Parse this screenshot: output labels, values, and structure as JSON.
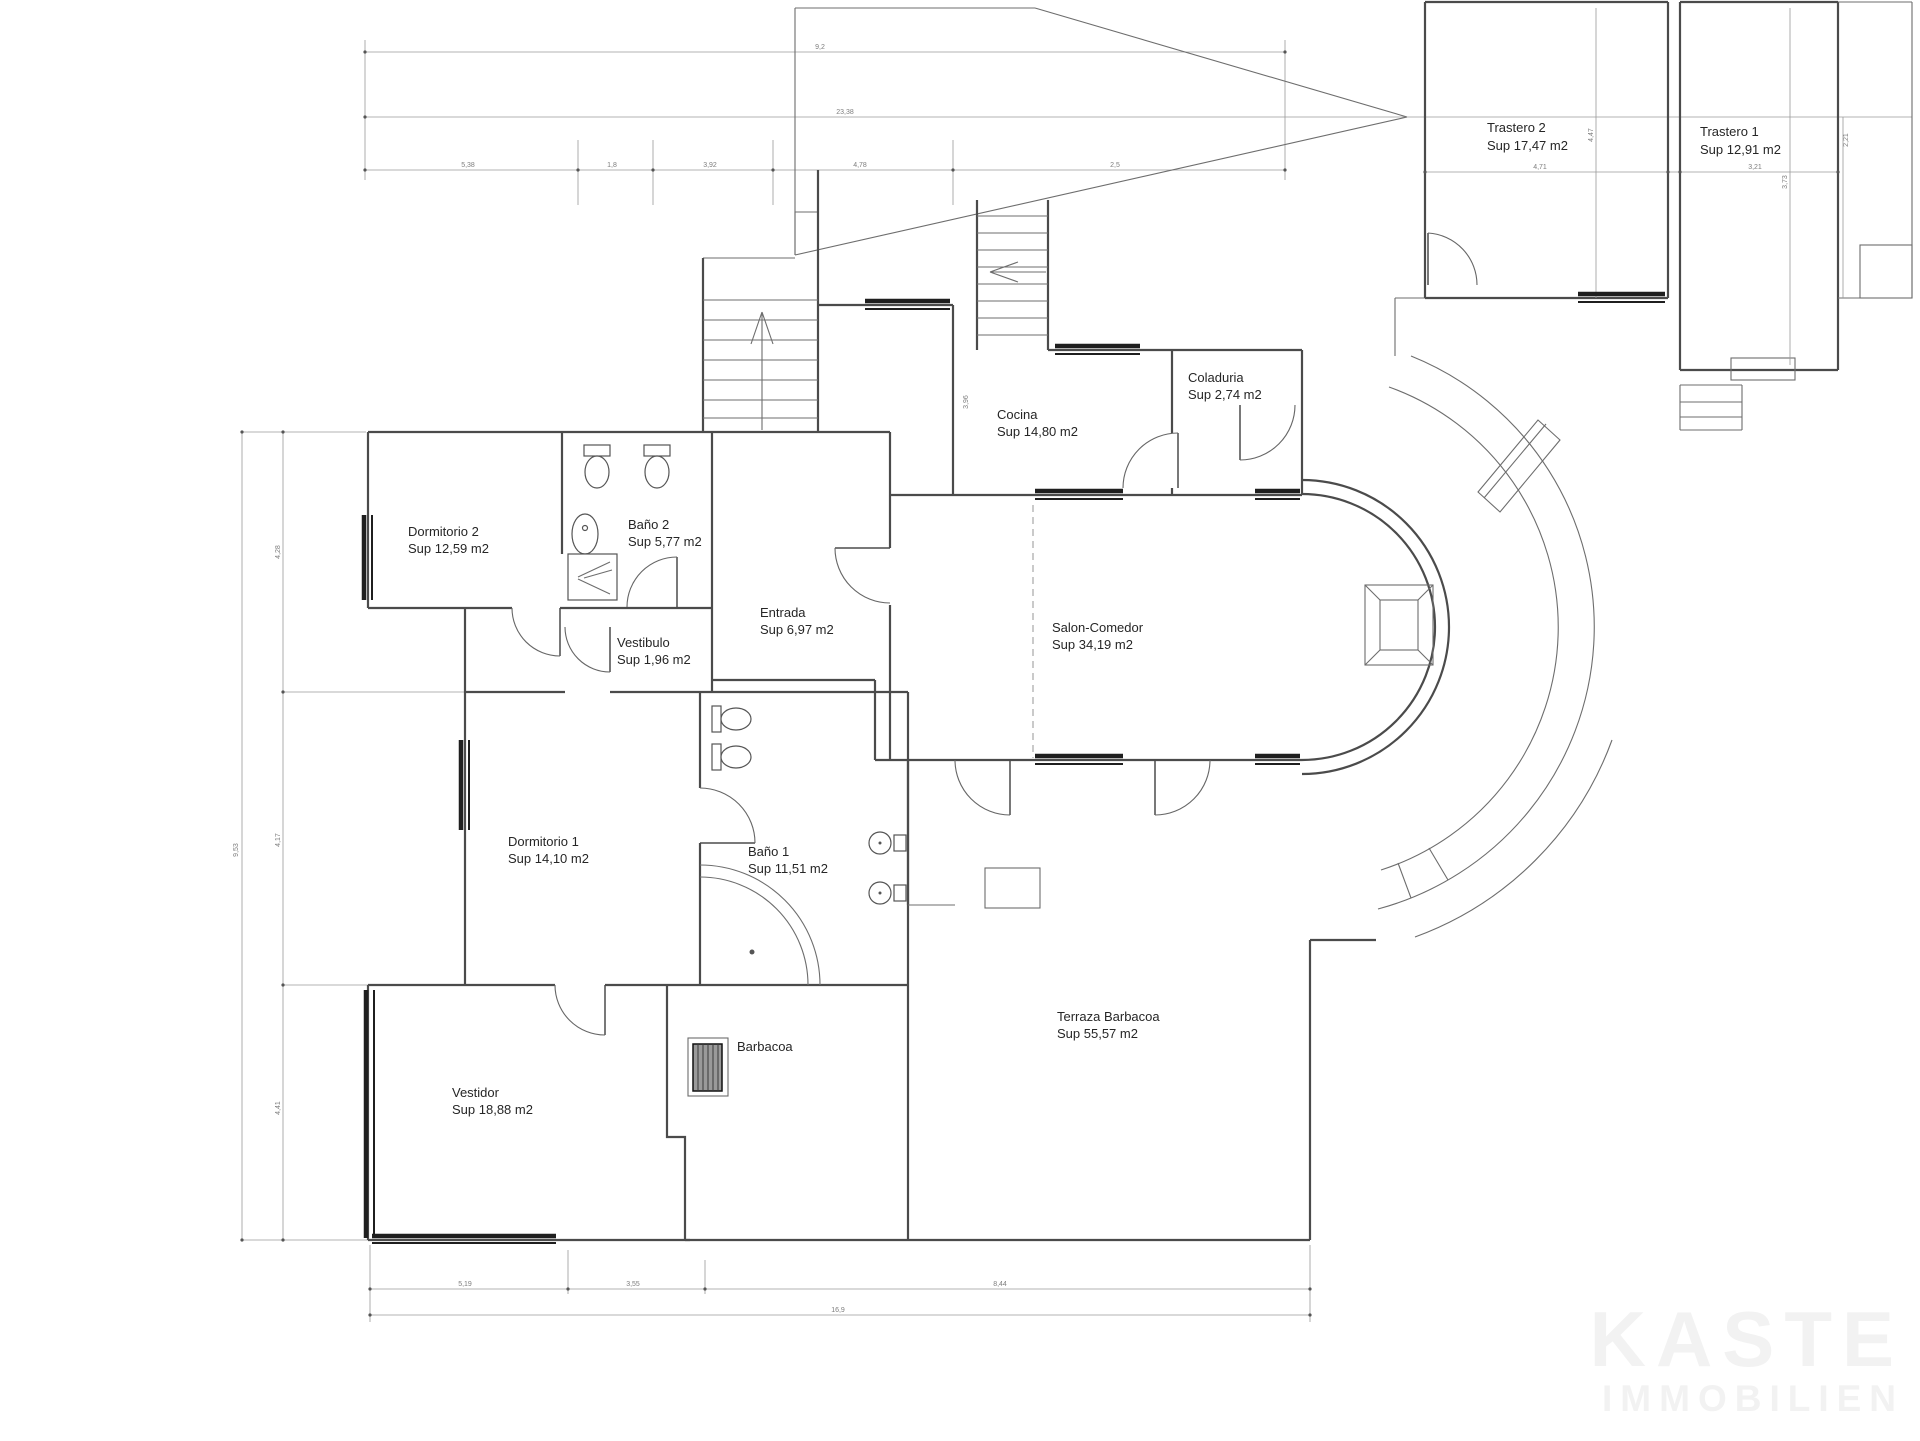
{
  "watermark": {
    "line1": "KASTE",
    "line2": "IMMOBILIEN",
    "color": "#f2f2f2"
  },
  "rooms": [
    {
      "name": "Trastero 2",
      "area": "Sup 17,47 m2"
    },
    {
      "name": "Trastero 1",
      "area": "Sup 12,91 m2"
    },
    {
      "name": "Coladuria",
      "area": "Sup 2,74 m2"
    },
    {
      "name": "Cocina",
      "area": "Sup 14,80 m2"
    },
    {
      "name": "Dormitorio 2",
      "area": "Sup 12,59 m2"
    },
    {
      "name": "Baño 2",
      "area": "Sup 5,77 m2"
    },
    {
      "name": "Vestibulo",
      "area": "Sup 1,96 m2"
    },
    {
      "name": "Entrada",
      "area": "Sup 6,97 m2"
    },
    {
      "name": "Salon-Comedor",
      "area": "Sup 34,19 m2"
    },
    {
      "name": "Dormitorio 1",
      "area": "Sup 14,10 m2"
    },
    {
      "name": "Baño 1",
      "area": "Sup 11,51 m2"
    },
    {
      "name": "Vestidor",
      "area": "Sup 18,88 m2"
    },
    {
      "name": "Barbacoa",
      "area": ""
    },
    {
      "name": "Terraza Barbacoa",
      "area": "Sup 55,57 m2"
    }
  ],
  "dims": {
    "top_total": "9,2",
    "top_width": "23,38",
    "top_segments": [
      "5,38",
      "1,8",
      "3,92",
      "4,78",
      "2,5"
    ],
    "left_total": "9,53",
    "left_segments": [
      "4,28",
      "4,17",
      "4,41"
    ],
    "bottom_segments": [
      "5,19",
      "3,55",
      "8,44"
    ],
    "bottom_total": "16,9",
    "trastero2_width": "4,71",
    "trastero1_width": "3,21",
    "trastero2_height": "4,47",
    "trastero1_height": "3,73",
    "right_edge": "2,21",
    "stair_dim": "3,96"
  }
}
